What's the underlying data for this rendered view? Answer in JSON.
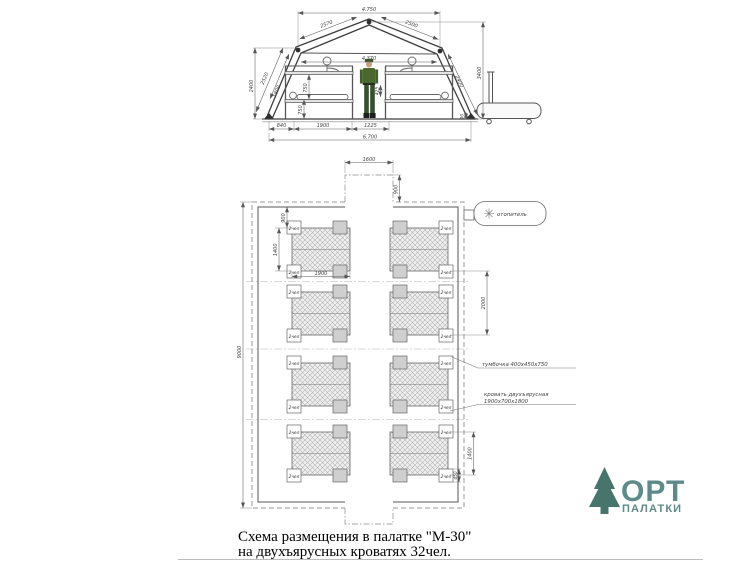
{
  "cross_section": {
    "dims": {
      "top_width": "4.750",
      "roof_left": "2570",
      "roof_right": "2500",
      "inner_width": "4.370",
      "left_height": "2400",
      "wall_slope_left": "2520",
      "wall_slope_left2": "1800",
      "tier_upper": "750",
      "tier_lower": "750",
      "aisle_head": "425",
      "wall_slope_right": "2400",
      "right_height": "3400",
      "plinth": "90",
      "base_left": "840",
      "base_bed": "1900",
      "base_aisle": "1225",
      "total_width": "6.700"
    }
  },
  "plan": {
    "dims": {
      "entry_width": "1600",
      "entry_depth": "900",
      "top_gap": "900",
      "block_depth": "1400",
      "bed_length": "1900",
      "total_length": "9000",
      "row_gap": "2000",
      "bottom_block": "1400",
      "nightstand_width": "450"
    },
    "labels": {
      "heater": "отопитель",
      "nightstand_note": "тумбочка 400х450х750",
      "bed_note_line1": "кровать двухъярусная",
      "bed_note_line2": "1900х700х1800",
      "bed_capacity": "2чел"
    }
  },
  "caption": {
    "line1": "Схема размещения в палатке \"М-30\"",
    "line2": "на двухъярусных кроватях 32чел."
  },
  "logo": {
    "title": "ОРТ",
    "subtitle": "ПАЛАТКИ",
    "text_color": "#5e8a8a",
    "tree_color": "#47756c"
  }
}
